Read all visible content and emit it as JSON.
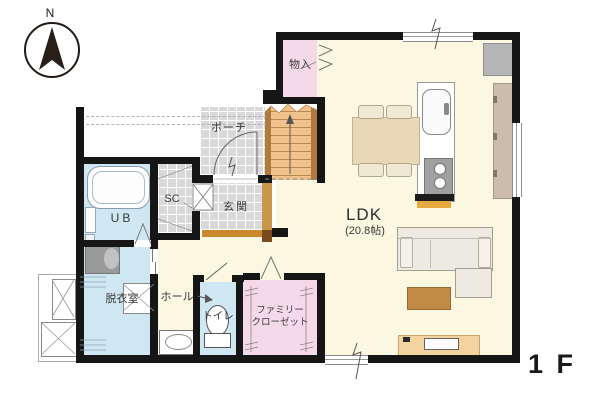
{
  "floor_label": "1 F",
  "compass": {
    "north_label": "N"
  },
  "rooms": {
    "ldk": {
      "name": "LDK",
      "area": "(20.8帖)"
    },
    "storage": {
      "name": "物入"
    },
    "porch": {
      "name": "ポーチ"
    },
    "shoe_closet": {
      "name": "SC"
    },
    "entrance": {
      "name": "玄関"
    },
    "unit_bath": {
      "name": "UB"
    },
    "dressing_room": {
      "name": "脱衣室"
    },
    "hall": {
      "name": "ホール"
    },
    "toilet": {
      "name": "トイレ"
    },
    "family_closet": {
      "name_line1": "ファミリー",
      "name_line2": "クローゼット"
    }
  },
  "colors": {
    "wall": "#161616",
    "floor_cream": "#fbf7e0",
    "room_pink": "#f5d9e8",
    "room_blue": "#cfe7f2",
    "tile_gray": "#d9d9d9",
    "stair_orange": "#f2c28d",
    "stair_rail": "#b0793e",
    "wood_light": "#c9964a",
    "wood_mid": "#c9882b",
    "wood_dark": "#7a4a1e",
    "furniture_tan": "#e9d7b8",
    "tv_board_tan": "#f3d3a0",
    "table_brown": "#c18a47",
    "sofa_ivory": "#edeae2",
    "appliance_gray": "#b5b5b5",
    "counter_taupe": "#cbbcab"
  }
}
